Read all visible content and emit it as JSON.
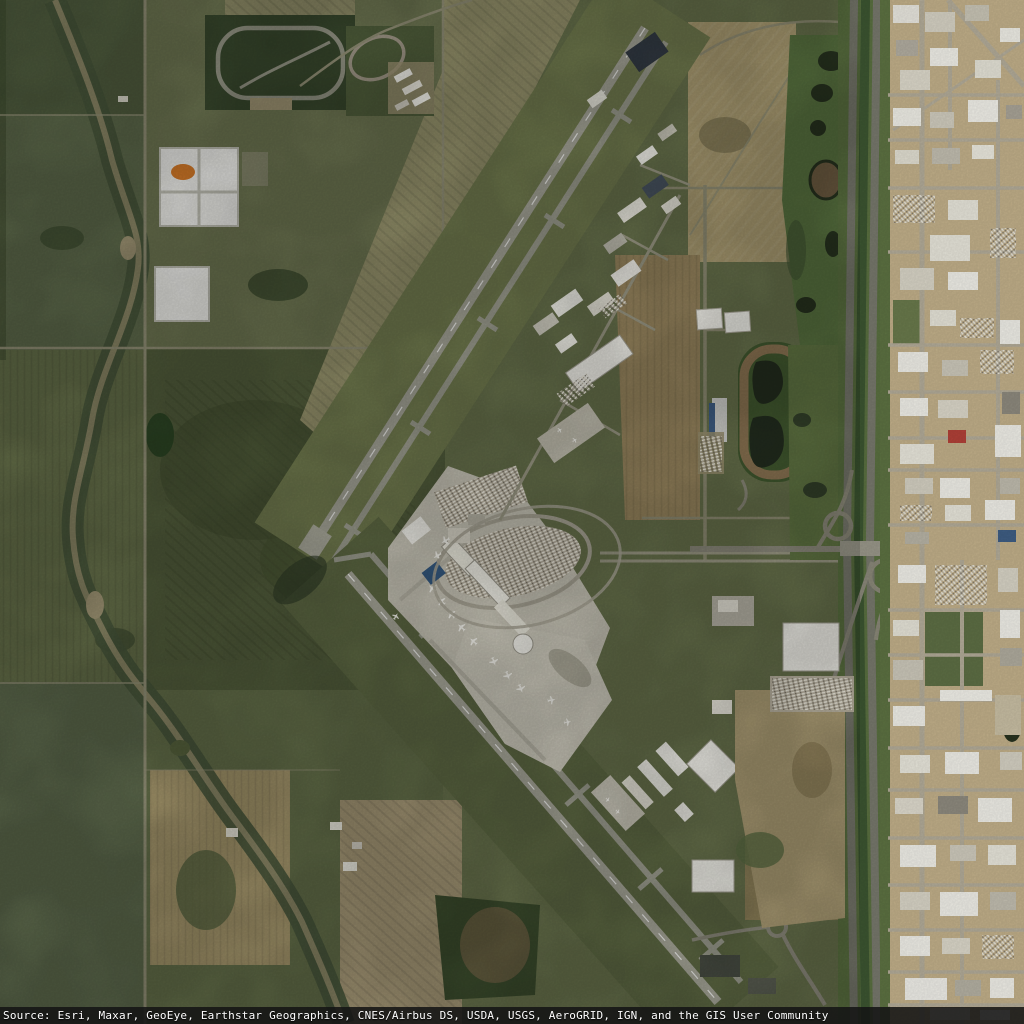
{
  "map": {
    "type": "satellite-imagery-basemap",
    "attribution": "Source: Esri, Maxar, GeoEye, Earthstar Geographics, CNES/Airbus DS, USDA, USGS, AeroGRID, IGN, and the GIS User Community"
  },
  "palette": {
    "field_olive": "#66704b",
    "field_dark": "#4d5838",
    "field_tan": "#a0946c",
    "stubble_tan": "#93906a",
    "wetland_dark": "#27321f",
    "runway_gray": "#a2a295",
    "apron_light": "#c6c3b5",
    "building_white": "#f0efe8",
    "highway_gray": "#77786c",
    "urban_tan": "#c2b08a",
    "water_dark": "#20281c",
    "racetrack_dirt": "#8a7352",
    "attribution_bg": "#141414",
    "attribution_text": "#ffffff"
  }
}
